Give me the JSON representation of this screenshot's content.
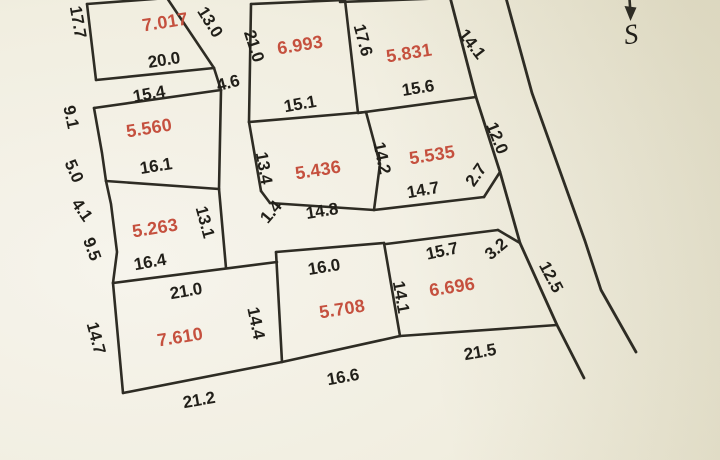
{
  "colors": {
    "paper_light": "#f6f4ec",
    "paper_dark": "#ded9bd",
    "line": "#2e2c24",
    "dim_text": "#211f19",
    "area_text": "#c5503e"
  },
  "north_arrow": {
    "label": "S"
  },
  "parcels": [
    {
      "id": "p-7017",
      "area": "7.017",
      "sides": [
        "17.7",
        "13.0",
        "20.0"
      ]
    },
    {
      "id": "p-6993",
      "area": "6.993",
      "sides": [
        "21.0",
        "17.6",
        "15.1"
      ]
    },
    {
      "id": "p-5831",
      "area": "5.831",
      "sides": [
        "17.6",
        "14.1",
        "15.6"
      ]
    },
    {
      "id": "p-5560",
      "area": "5.560",
      "sides": [
        "15.4",
        "4.6",
        "9.1",
        "5.0",
        "16.1"
      ]
    },
    {
      "id": "p-5436",
      "area": "5.436",
      "sides": [
        "15.1",
        "13.4",
        "14.2",
        "14.8",
        "1.4"
      ]
    },
    {
      "id": "p-5535",
      "area": "5.535",
      "sides": [
        "15.6",
        "12.0",
        "2.7",
        "14.7",
        "14.2"
      ]
    },
    {
      "id": "p-5263",
      "area": "5.263",
      "sides": [
        "16.1",
        "13.1",
        "16.4",
        "4.1",
        "9.5"
      ]
    },
    {
      "id": "p-7610",
      "area": "7.610",
      "sides": [
        "21.0",
        "14.4",
        "21.2",
        "14.7"
      ]
    },
    {
      "id": "p-5708",
      "area": "5.708",
      "sides": [
        "16.0",
        "14.1",
        "16.6",
        "14.4"
      ]
    },
    {
      "id": "p-6696",
      "area": "6.696",
      "sides": [
        "15.7",
        "3.2",
        "12.5",
        "21.5",
        "14.1"
      ]
    }
  ],
  "labels": [
    {
      "t": "17.7",
      "x": 78,
      "y": 22,
      "r": 80,
      "k": "dim"
    },
    {
      "t": "13.0",
      "x": 210,
      "y": 22,
      "r": 58,
      "k": "dim"
    },
    {
      "t": "20.0",
      "x": 164,
      "y": 60,
      "r": -9,
      "k": "dim"
    },
    {
      "t": "15.4",
      "x": 149,
      "y": 94,
      "r": -10,
      "k": "dim"
    },
    {
      "t": "4.6",
      "x": 228,
      "y": 83,
      "r": -15,
      "k": "dim"
    },
    {
      "t": "9.1",
      "x": 71,
      "y": 117,
      "r": 78,
      "k": "dim"
    },
    {
      "t": "5.0",
      "x": 74,
      "y": 171,
      "r": 66,
      "k": "dim"
    },
    {
      "t": "16.1",
      "x": 156,
      "y": 166,
      "r": -9,
      "k": "dim"
    },
    {
      "t": "4.1",
      "x": 82,
      "y": 210,
      "r": 55,
      "k": "dim"
    },
    {
      "t": "9.5",
      "x": 92,
      "y": 249,
      "r": 70,
      "k": "dim"
    },
    {
      "t": "21.0",
      "x": 254,
      "y": 46,
      "r": 72,
      "k": "dim"
    },
    {
      "t": "17.6",
      "x": 363,
      "y": 40,
      "r": 75,
      "k": "dim"
    },
    {
      "t": "14.1",
      "x": 472,
      "y": 44,
      "r": 52,
      "k": "dim"
    },
    {
      "t": "15.6",
      "x": 418,
      "y": 88,
      "r": -9,
      "k": "dim"
    },
    {
      "t": "15.1",
      "x": 300,
      "y": 104,
      "r": -10,
      "k": "dim"
    },
    {
      "t": "13.4",
      "x": 264,
      "y": 168,
      "r": 80,
      "k": "dim"
    },
    {
      "t": "14.2",
      "x": 382,
      "y": 158,
      "r": 78,
      "k": "dim"
    },
    {
      "t": "14.8",
      "x": 322,
      "y": 211,
      "r": -9,
      "k": "dim"
    },
    {
      "t": "1.4",
      "x": 271,
      "y": 212,
      "r": -50,
      "k": "dim"
    },
    {
      "t": "14.7",
      "x": 423,
      "y": 190,
      "r": -10,
      "k": "dim"
    },
    {
      "t": "2.7",
      "x": 476,
      "y": 175,
      "r": -55,
      "k": "dim"
    },
    {
      "t": "12.0",
      "x": 497,
      "y": 138,
      "r": 68,
      "k": "dim"
    },
    {
      "t": "13.1",
      "x": 205,
      "y": 222,
      "r": 75,
      "k": "dim"
    },
    {
      "t": "16.4",
      "x": 150,
      "y": 262,
      "r": -10,
      "k": "dim"
    },
    {
      "t": "21.0",
      "x": 186,
      "y": 291,
      "r": -10,
      "k": "dim"
    },
    {
      "t": "14.7",
      "x": 96,
      "y": 338,
      "r": 75,
      "k": "dim"
    },
    {
      "t": "14.4",
      "x": 256,
      "y": 323,
      "r": 78,
      "k": "dim"
    },
    {
      "t": "21.2",
      "x": 199,
      "y": 400,
      "r": -10,
      "k": "dim"
    },
    {
      "t": "16.0",
      "x": 324,
      "y": 267,
      "r": -9,
      "k": "dim"
    },
    {
      "t": "16.6",
      "x": 343,
      "y": 377,
      "r": -10,
      "k": "dim"
    },
    {
      "t": "14.1",
      "x": 401,
      "y": 297,
      "r": 80,
      "k": "dim"
    },
    {
      "t": "15.7",
      "x": 442,
      "y": 251,
      "r": -12,
      "k": "dim"
    },
    {
      "t": "3.2",
      "x": 496,
      "y": 249,
      "r": -40,
      "k": "dim"
    },
    {
      "t": "21.5",
      "x": 480,
      "y": 352,
      "r": -10,
      "k": "dim"
    },
    {
      "t": "12.5",
      "x": 551,
      "y": 277,
      "r": 62,
      "k": "dim"
    },
    {
      "t": "7.017",
      "x": 165,
      "y": 22,
      "r": -9,
      "k": "area"
    },
    {
      "t": "6.993",
      "x": 300,
      "y": 45,
      "r": -9,
      "k": "area"
    },
    {
      "t": "5.831",
      "x": 409,
      "y": 53,
      "r": -9,
      "k": "area"
    },
    {
      "t": "5.560",
      "x": 149,
      "y": 128,
      "r": -9,
      "k": "area"
    },
    {
      "t": "5.436",
      "x": 318,
      "y": 170,
      "r": -9,
      "k": "area"
    },
    {
      "t": "5.535",
      "x": 432,
      "y": 155,
      "r": -9,
      "k": "area"
    },
    {
      "t": "5.263",
      "x": 155,
      "y": 228,
      "r": -9,
      "k": "area"
    },
    {
      "t": "7.610",
      "x": 180,
      "y": 337,
      "r": -9,
      "k": "area"
    },
    {
      "t": "5.708",
      "x": 342,
      "y": 309,
      "r": -9,
      "k": "area"
    },
    {
      "t": "6.696",
      "x": 452,
      "y": 287,
      "r": -9,
      "k": "area"
    },
    {
      "t": "S",
      "x": 631,
      "y": 35,
      "r": -8,
      "k": "north"
    }
  ]
}
